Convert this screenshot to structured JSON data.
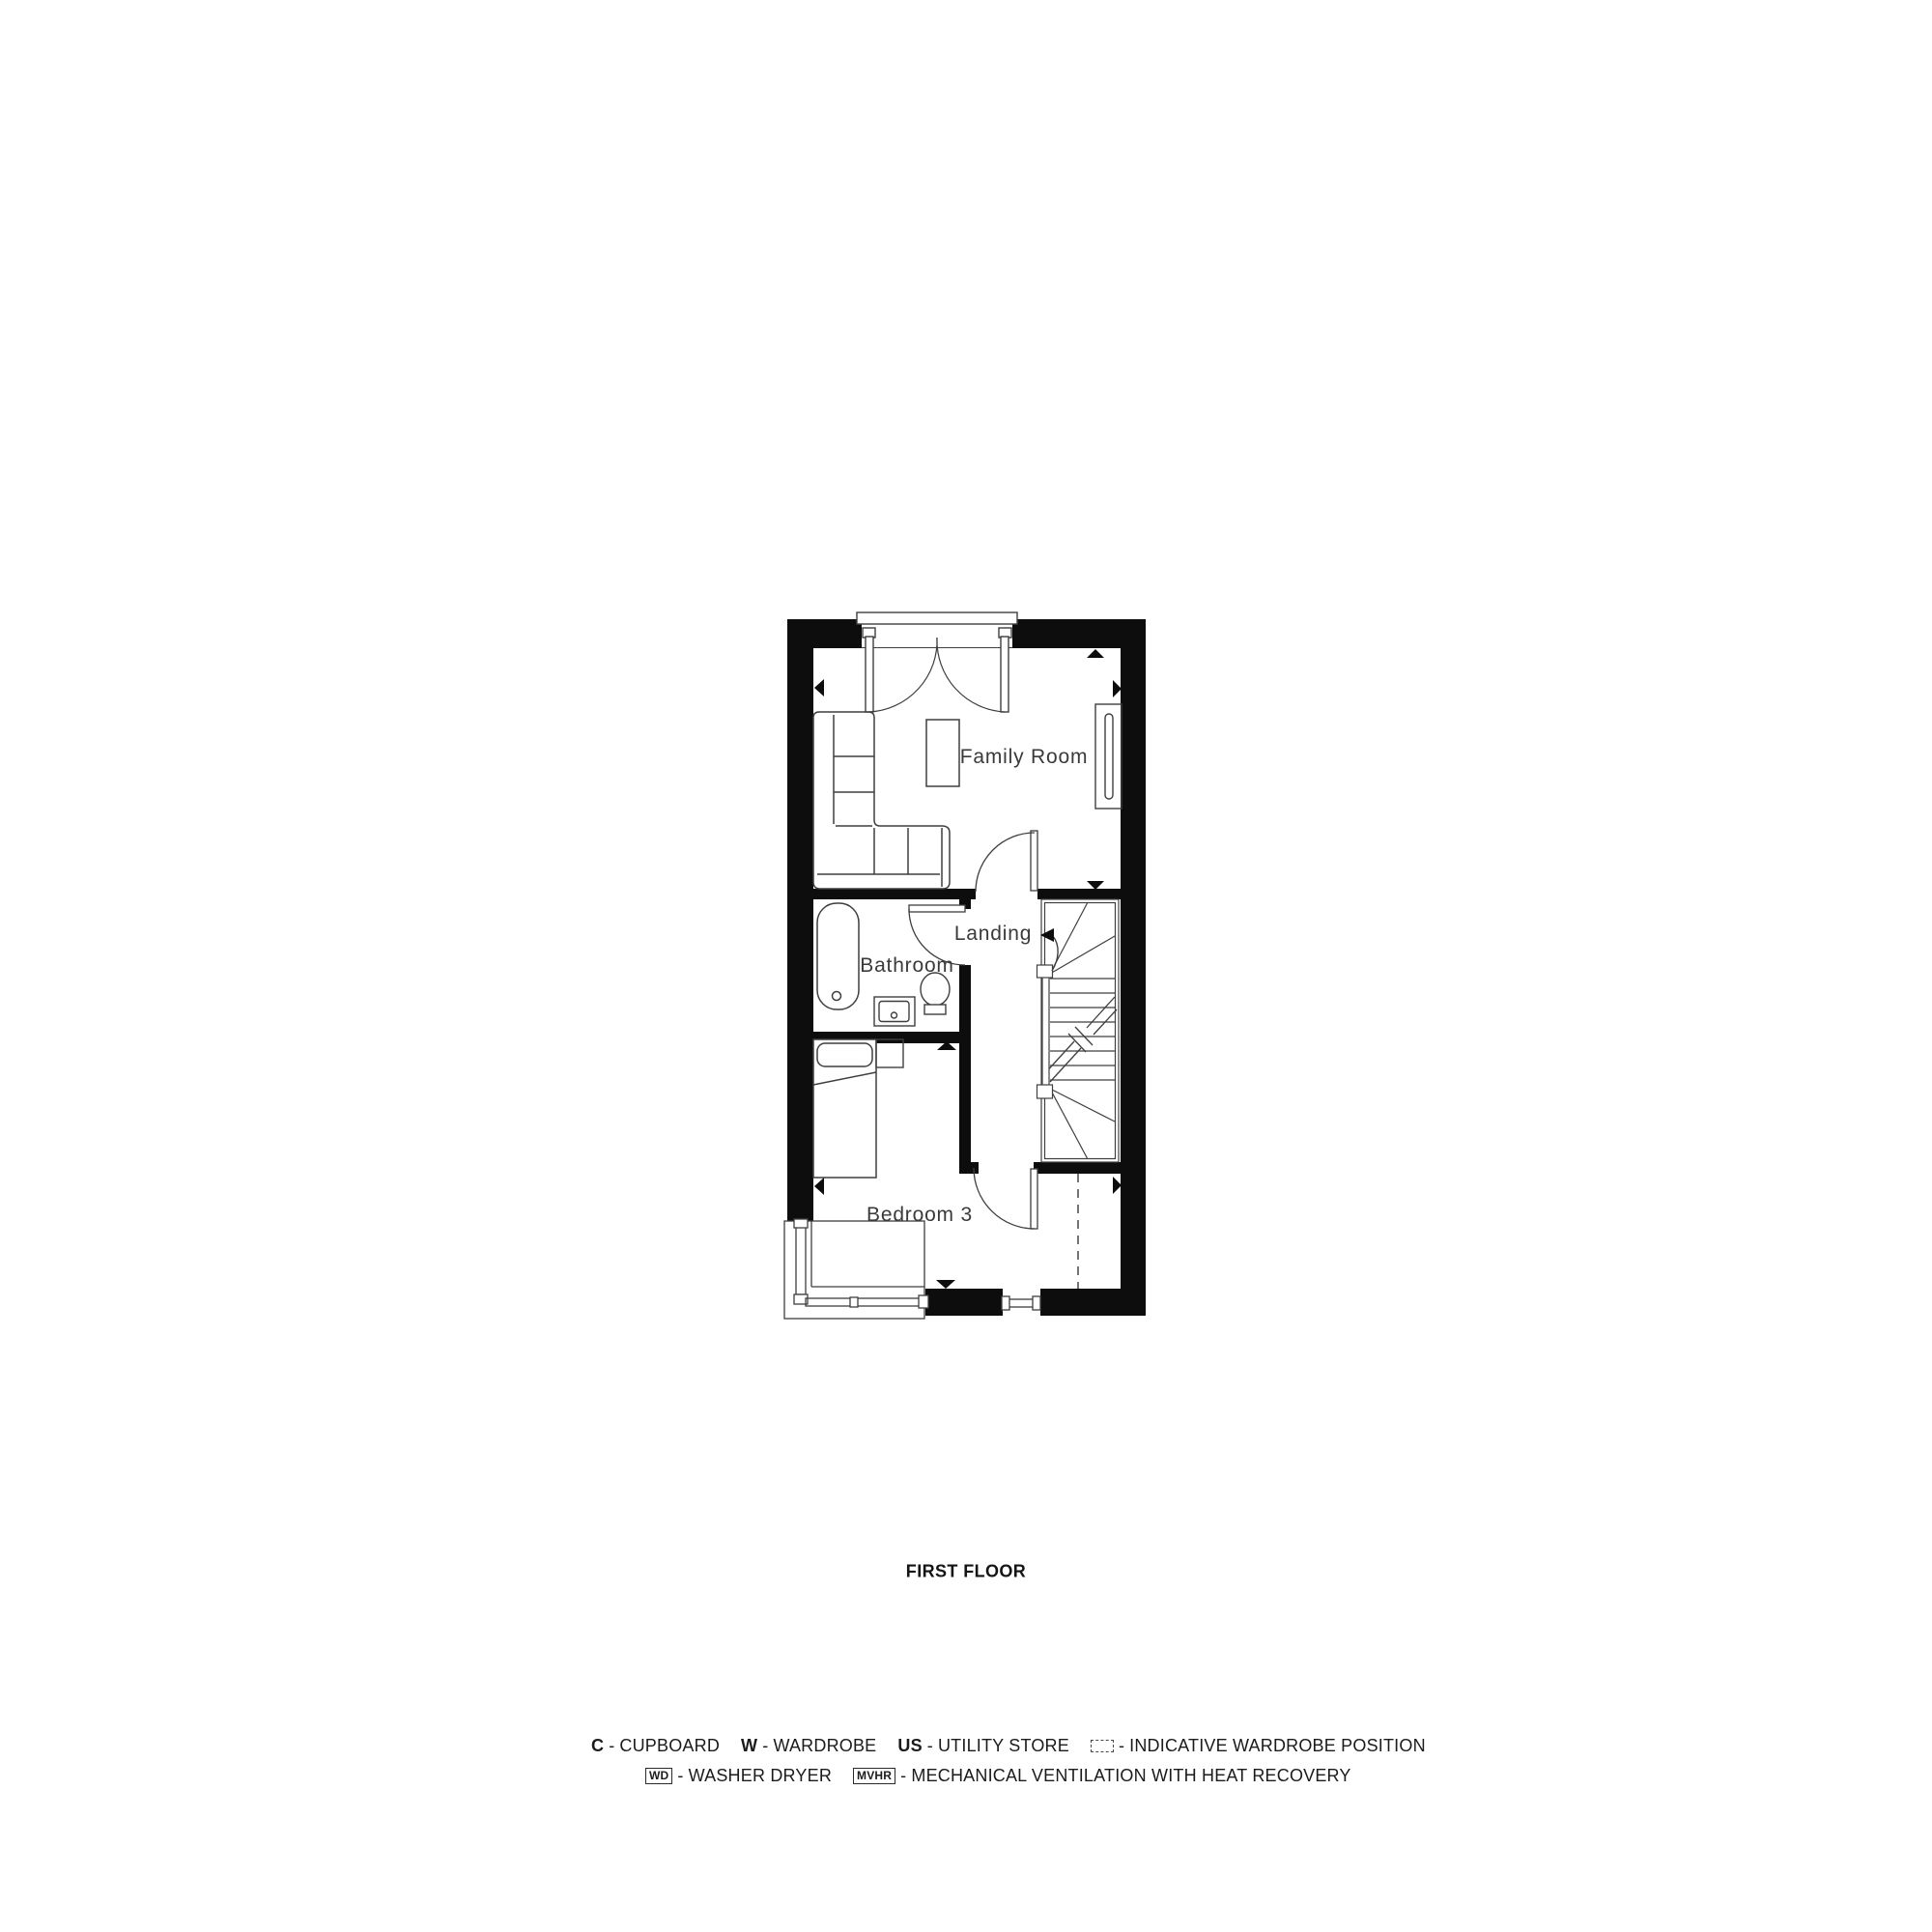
{
  "plan": {
    "title": "FIRST FLOOR",
    "rooms": {
      "family": "Family Room",
      "landing": "Landing",
      "bathroom": "Bathroom",
      "bedroom3": "Bedroom 3"
    },
    "colors": {
      "wall": "#0d0d0d",
      "line": "#3f3f3f",
      "label": "#3a3a3a"
    }
  },
  "legend": {
    "separator": "-",
    "row1": {
      "i1": {
        "key": "C",
        "text": "CUPBOARD"
      },
      "i2": {
        "key": "W",
        "text": "WARDROBE"
      },
      "i3": {
        "key": "US",
        "text": "UTILITY STORE"
      },
      "i4": {
        "text": "INDICATIVE WARDROBE POSITION"
      }
    },
    "row2": {
      "i1": {
        "key": "WD",
        "text": "WASHER DRYER"
      },
      "i2": {
        "key": "MVHR",
        "text": "MECHANICAL VENTILATION WITH HEAT RECOVERY"
      }
    }
  }
}
